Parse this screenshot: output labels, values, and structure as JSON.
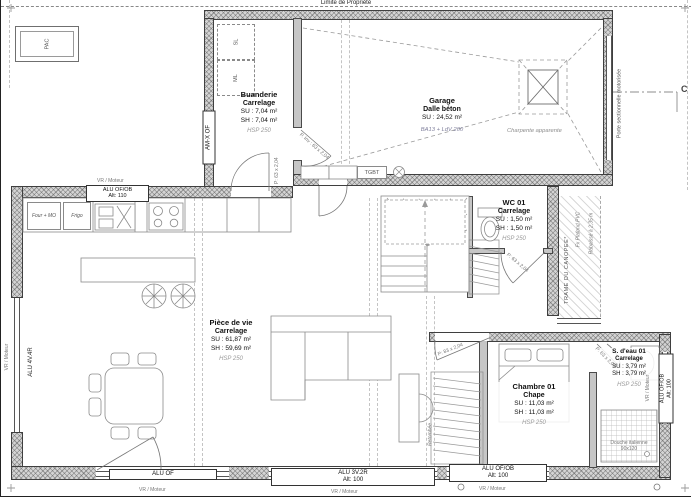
{
  "title": {
    "property_line": "Limite de Propriété"
  },
  "rooms": {
    "buanderie": {
      "name": "Buanderie",
      "finish": "Carrelage",
      "su": "SU : 7,04 m²",
      "sh": "SH : 7,04 m²",
      "hsp": "HSP 250"
    },
    "garage": {
      "name": "Garage",
      "finish": "Dalle béton",
      "su": "SU : 24,52 m²",
      "note": "BA13 + LdV 200",
      "roof": "Charpente apparente"
    },
    "wc": {
      "name": "WC 01",
      "finish": "Carrelage",
      "su": "SU : 1,50 m²",
      "sh": "SH : 1,50 m²",
      "hsp": "HSP 250"
    },
    "piece_de_vie": {
      "name": "Pièce de vie",
      "finish": "Carrelage",
      "su": "SU : 61,87 m²",
      "sh": "SH : 59,69 m²",
      "hsp": "HSP 250"
    },
    "chambre": {
      "name": "Chambre 01",
      "finish": "Chape",
      "su": "SU : 11,03 m²",
      "sh": "SH : 11,03 m²",
      "hsp": "HSP 250"
    },
    "sdeau": {
      "name": "S. d'eau 01",
      "finish": "Carrelage",
      "su": "SU : 3,79 m²",
      "sh": "SH : 3,79 m²",
      "hsp": "HSP 250"
    }
  },
  "openings": {
    "amx": "AM-X OF",
    "kitchen_win": "ALU OF/OB",
    "kitchen_alt": "Alt: 110",
    "bay": "ALU 4V.4R",
    "bottom_left": "ALU OF",
    "bottom_center": "ALU 3V.2R",
    "bottom_center_alt": "Alt: 100",
    "bottom_right": "ALU OF/OB",
    "bottom_right_alt": "Alt: 100",
    "sdeau_win": "ALU OF/OB",
    "sdeau_alt": "Alt: 100",
    "vr": "VR / Moteur",
    "garage_door": "Porte sectionnelle motorisée",
    "door63": "P: 63 x 2,04",
    "door83": "P: 83 x 2,04",
    "doorinv": "P. Inv : 63 x 2,04"
  },
  "equipment": {
    "pac": "PAC",
    "sl": "SL",
    "ml": "ML",
    "four": "Four + MO",
    "frigo": "Frigo",
    "tgbt": "TGBT",
    "shower_l1": "Douche italienne",
    "shower_l2": "90x120"
  },
  "annotations": {
    "canopy": "TRAME DU CANOPEE*",
    "false_ceiling": "Fx Plafond PVC",
    "lowered": "Rabaissé à 2,35 m",
    "retombee": "Retombée",
    "section": "C"
  },
  "colors": {
    "wall": "#d4d4d4",
    "line": "#4a4a4a",
    "annotation": "#7f7f9c"
  }
}
